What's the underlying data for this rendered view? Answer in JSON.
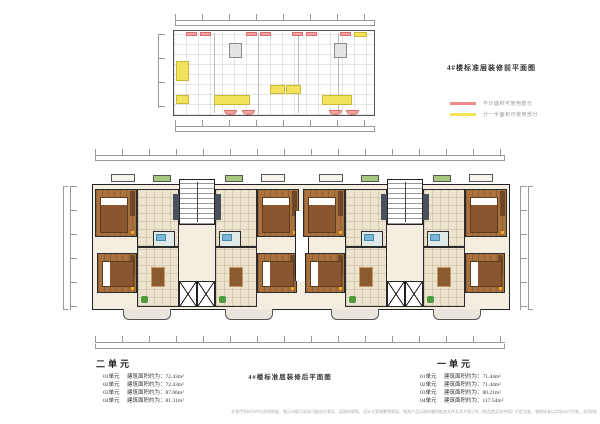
{
  "colors": {
    "legend_red": "#f08a8a",
    "legend_yellow": "#f2e25c",
    "wood_floor": "#a8713d",
    "tile_floor": "#ece4cf",
    "wall": "#2b2b2b"
  },
  "before_plan": {
    "title": "4#楼标准层装修前平面图",
    "legend": [
      {
        "label": "不计面积可使用部分",
        "color": "#f08a8a"
      },
      {
        "label": "计一半面积可使用部分",
        "color": "#f2e25c"
      }
    ]
  },
  "after_plan": {
    "title": "4#楼标准层装修后平面图"
  },
  "unit_summary": {
    "unit2": {
      "name": "二单元",
      "rows": [
        {
          "label": "01单元",
          "value": "建筑面积约为：72.43m²"
        },
        {
          "label": "02单元",
          "value": "建筑面积约为：72.43m²"
        },
        {
          "label": "03单元",
          "value": "建筑面积约为：87.06m²"
        },
        {
          "label": "04单元",
          "value": "建筑面积约为：81.31m²"
        }
      ]
    },
    "unit1": {
      "name": "一单元",
      "rows": [
        {
          "label": "01单元",
          "value": "建筑面积约为：71.44m²"
        },
        {
          "label": "02单元",
          "value": "建筑面积约为：71.44m²"
        },
        {
          "label": "03单元",
          "value": "建筑面积约为：80.21m²"
        },
        {
          "label": "04单元",
          "value": "建筑面积约为：117.54m²"
        }
      ]
    }
  },
  "footer": {
    "disclaimer": "本宣传资料不作为合同依据，图示内容与实际可能存在差异；因政府规划、设计方案调整等原因，相关产品以政府最终批准文件及双方签订的《商品房买卖合同》约定为准，装修标准以实际交付为准，本资料仅供参考，本公司保留最终解释权。"
  }
}
